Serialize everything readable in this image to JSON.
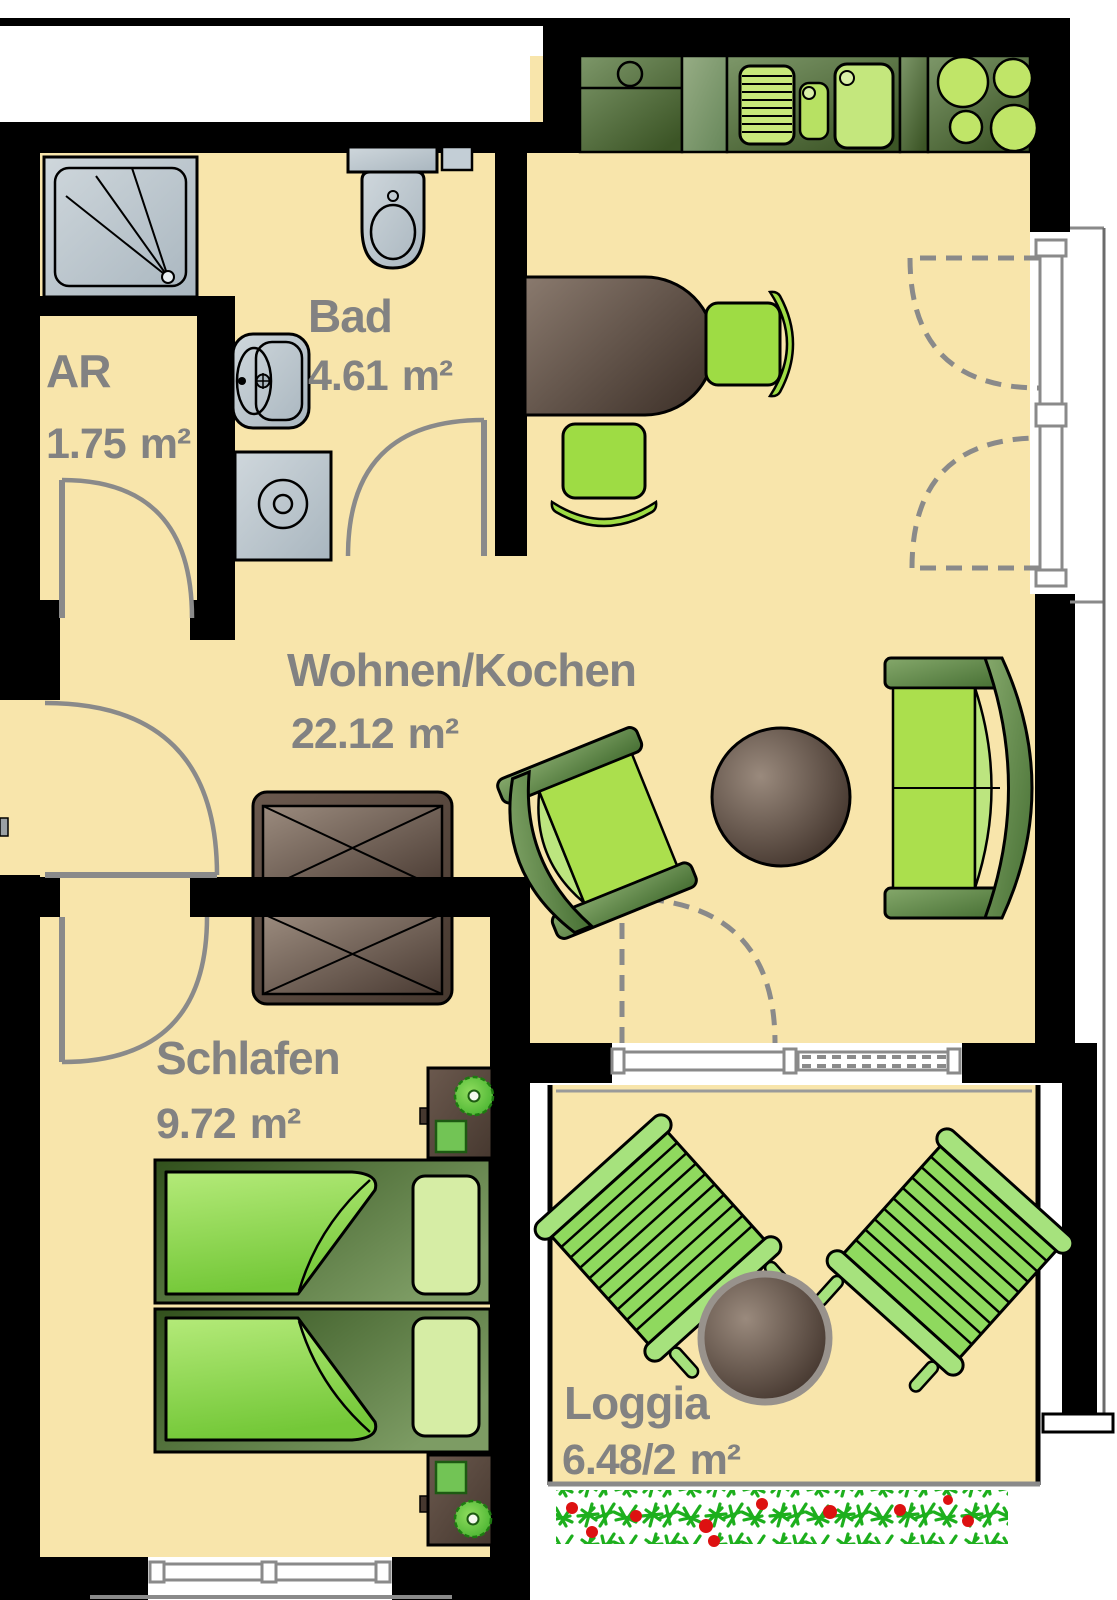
{
  "rooms": [
    {
      "name": "AR",
      "area": "1.75",
      "unit": "m²"
    },
    {
      "name": "Bad",
      "area": "4.61",
      "unit": "m²"
    },
    {
      "name": "Wohnen/Kochen",
      "area": "22.12",
      "unit": "m²"
    },
    {
      "name": "Schlafen",
      "area": "9.72",
      "unit": "m²"
    },
    {
      "name": "Loggia",
      "area": "6.48/2",
      "unit": "m²"
    }
  ],
  "fixtures": [
    "shower",
    "toilet",
    "washbasin",
    "washing-machine",
    "kitchen-counter",
    "kitchen-sink",
    "hob",
    "dining-table",
    "dining-chair",
    "wardrobe",
    "armchair",
    "coffee-table",
    "sofa",
    "bed",
    "duvet",
    "pillow",
    "nightstand",
    "plant",
    "loggia-table",
    "deck-chair",
    "flower-box",
    "entrance-door",
    "interior-door",
    "window",
    "balcony-door"
  ],
  "colors": {
    "floor": "#F8E5AB",
    "wall": "#000000",
    "outside": "#FFFFFF",
    "label": "#828282",
    "fixture_gray": "#C3CED6",
    "counter_dark_green": "#41592A",
    "counter_light_green": "#86A573",
    "appliance_green": "#C6E87E",
    "furniture_brown": "#5C4A3F",
    "sofa_frame_green": "#567F3B",
    "cushion_green": "#ABDF4D",
    "bed_green": "#8FD95E",
    "duvet_green": "#A5E061",
    "flower_green": "#1DAF1D",
    "flower_red": "#DD1111",
    "door_arc_gray": "#8A8A8A",
    "window_frame_gray": "#8A8A8A"
  }
}
